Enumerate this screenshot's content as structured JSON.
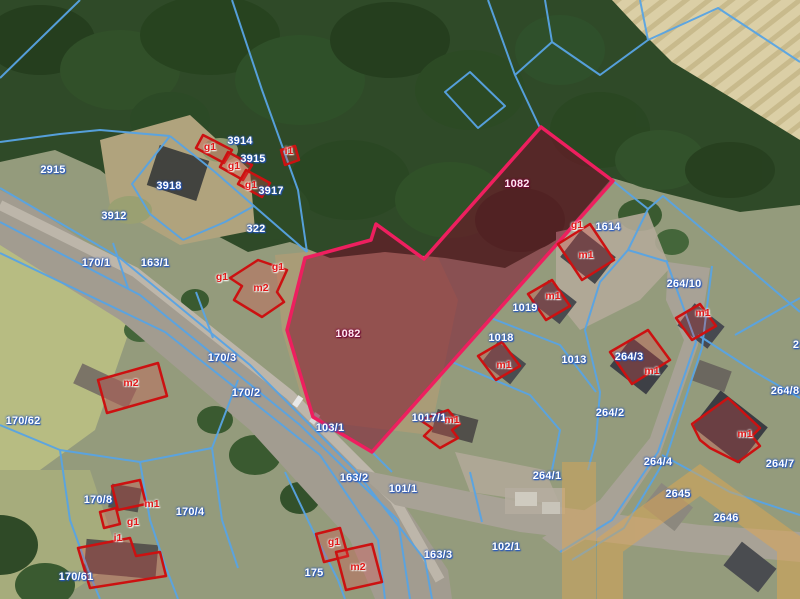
{
  "map": {
    "kind": "cadastral-parcel-map-over-aerial-photo",
    "selected_parcel": {
      "number": "1082",
      "outline_color": "#ee1f5f",
      "fill_color": "rgba(125,5,40,0.5)"
    },
    "colors": {
      "parcel_line": "#58a4e4",
      "parcel_label": "#ffffff",
      "parcel_label_halo": "rgba(35,85,190,0.95)",
      "building_outline": "#cc1111",
      "building_fill": "rgba(235,70,70,0.28)",
      "building_label": "#e01818",
      "watermark": "rgba(224,166,80,0.5)"
    },
    "parcel_labels": [
      {
        "text": "2915",
        "x": 53,
        "y": 170
      },
      {
        "text": "3914",
        "x": 240,
        "y": 141
      },
      {
        "text": "3915",
        "x": 253,
        "y": 159
      },
      {
        "text": "3917",
        "x": 271,
        "y": 191
      },
      {
        "text": "3918",
        "x": 169,
        "y": 186
      },
      {
        "text": "3912",
        "x": 114,
        "y": 216
      },
      {
        "text": "322",
        "x": 256,
        "y": 229
      },
      {
        "text": "170/1",
        "x": 96,
        "y": 263
      },
      {
        "text": "163/1",
        "x": 155,
        "y": 263
      },
      {
        "text": "1082",
        "x": 517,
        "y": 184,
        "selected": true
      },
      {
        "text": "1082",
        "x": 348,
        "y": 334,
        "selected": true
      },
      {
        "text": "1614",
        "x": 608,
        "y": 227
      },
      {
        "text": "264/10",
        "x": 684,
        "y": 284
      },
      {
        "text": "1019",
        "x": 525,
        "y": 308
      },
      {
        "text": "1018",
        "x": 501,
        "y": 338
      },
      {
        "text": "1013",
        "x": 574,
        "y": 360
      },
      {
        "text": "264/3",
        "x": 629,
        "y": 357
      },
      {
        "text": "264/2",
        "x": 610,
        "y": 413
      },
      {
        "text": "264/8",
        "x": 785,
        "y": 391
      },
      {
        "text": "2",
        "x": 796,
        "y": 345
      },
      {
        "text": "170/3",
        "x": 222,
        "y": 358
      },
      {
        "text": "170/2",
        "x": 246,
        "y": 393
      },
      {
        "text": "170/62",
        "x": 23,
        "y": 421
      },
      {
        "text": "1017/1",
        "x": 429,
        "y": 418
      },
      {
        "text": "103/1",
        "x": 330,
        "y": 428
      },
      {
        "text": "163/2",
        "x": 354,
        "y": 478
      },
      {
        "text": "101/1",
        "x": 403,
        "y": 489
      },
      {
        "text": "264/1",
        "x": 547,
        "y": 476
      },
      {
        "text": "264/4",
        "x": 658,
        "y": 462
      },
      {
        "text": "2645",
        "x": 678,
        "y": 494
      },
      {
        "text": "2646",
        "x": 726,
        "y": 518
      },
      {
        "text": "264/7",
        "x": 780,
        "y": 464
      },
      {
        "text": "163/3",
        "x": 438,
        "y": 555
      },
      {
        "text": "102/1",
        "x": 506,
        "y": 547
      },
      {
        "text": "175",
        "x": 314,
        "y": 573
      },
      {
        "text": "170/8",
        "x": 98,
        "y": 500
      },
      {
        "text": "170/4",
        "x": 190,
        "y": 512
      },
      {
        "text": "170/61",
        "x": 76,
        "y": 577
      }
    ],
    "building_labels": [
      {
        "text": "g1",
        "x": 210,
        "y": 147
      },
      {
        "text": "g1",
        "x": 234,
        "y": 166
      },
      {
        "text": "g1",
        "x": 251,
        "y": 185
      },
      {
        "text": "i1",
        "x": 289,
        "y": 151
      },
      {
        "text": "g1",
        "x": 222,
        "y": 277
      },
      {
        "text": "g1",
        "x": 278,
        "y": 267
      },
      {
        "text": "m2",
        "x": 261,
        "y": 288
      },
      {
        "text": "m2",
        "x": 131,
        "y": 383
      },
      {
        "text": "g1",
        "x": 577,
        "y": 225
      },
      {
        "text": "m1",
        "x": 586,
        "y": 255
      },
      {
        "text": "m1",
        "x": 553,
        "y": 296
      },
      {
        "text": "m1",
        "x": 504,
        "y": 365
      },
      {
        "text": "m1",
        "x": 452,
        "y": 420
      },
      {
        "text": "m1",
        "x": 652,
        "y": 371
      },
      {
        "text": "m1",
        "x": 703,
        "y": 313
      },
      {
        "text": "m1",
        "x": 745,
        "y": 434
      },
      {
        "text": "m1",
        "x": 152,
        "y": 504
      },
      {
        "text": "g1",
        "x": 133,
        "y": 522
      },
      {
        "text": "i1",
        "x": 118,
        "y": 538
      },
      {
        "text": "g1",
        "x": 334,
        "y": 542
      },
      {
        "text": "m2",
        "x": 358,
        "y": 567
      }
    ]
  }
}
